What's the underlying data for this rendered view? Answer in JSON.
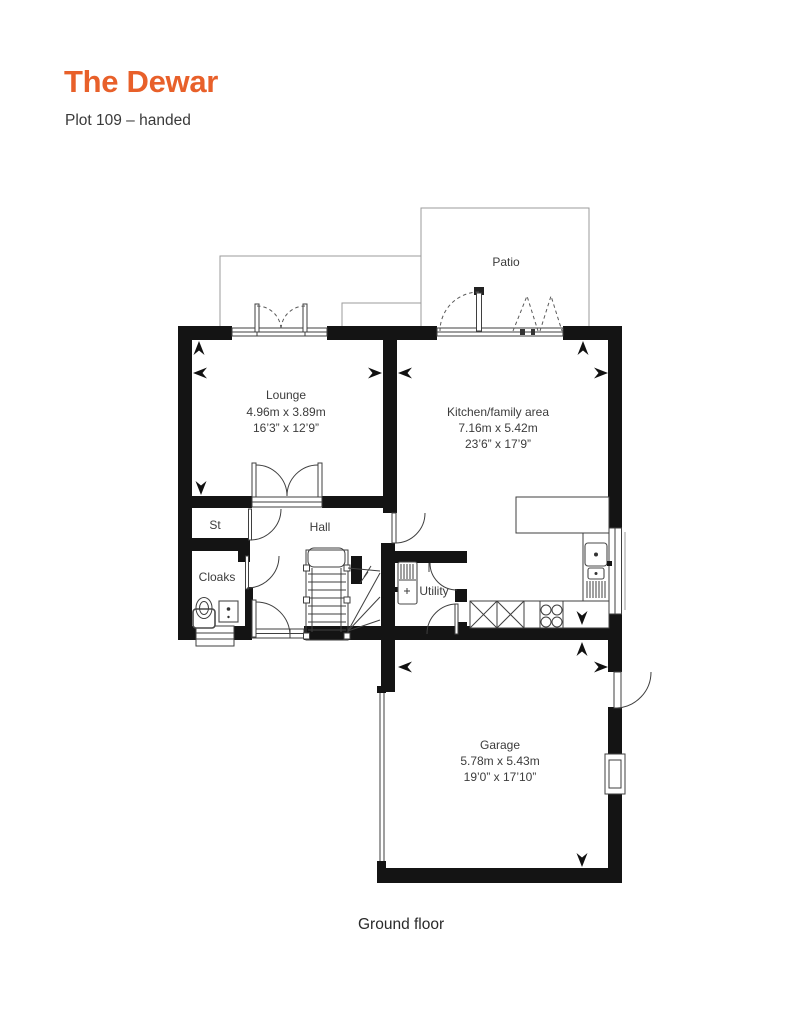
{
  "header": {
    "title": "The Dewar",
    "subtitle": "Plot 109 – handed"
  },
  "caption": "Ground floor",
  "colors": {
    "accent": "#E8602A",
    "wall": "#141414",
    "line": "#3f3f3f",
    "paving_line": "#9b9b9b",
    "label_text": "#3c3c3c"
  },
  "rooms": {
    "lounge": {
      "name": "Lounge",
      "metric": "4.96m x 3.89m",
      "imperial": "16’3” x 12’9”"
    },
    "kitchen": {
      "name": "Kitchen/family area",
      "metric": "7.16m x 5.42m",
      "imperial": "23’6” x 17’9”"
    },
    "garage": {
      "name": "Garage",
      "metric": "5.78m x 5.43m",
      "imperial": "19’0” x 17’10”"
    },
    "patio": {
      "name": "Patio"
    },
    "st": {
      "name": "St"
    },
    "hall": {
      "name": "Hall"
    },
    "cloaks": {
      "name": "Cloaks"
    },
    "utility": {
      "name": "Utility"
    }
  }
}
